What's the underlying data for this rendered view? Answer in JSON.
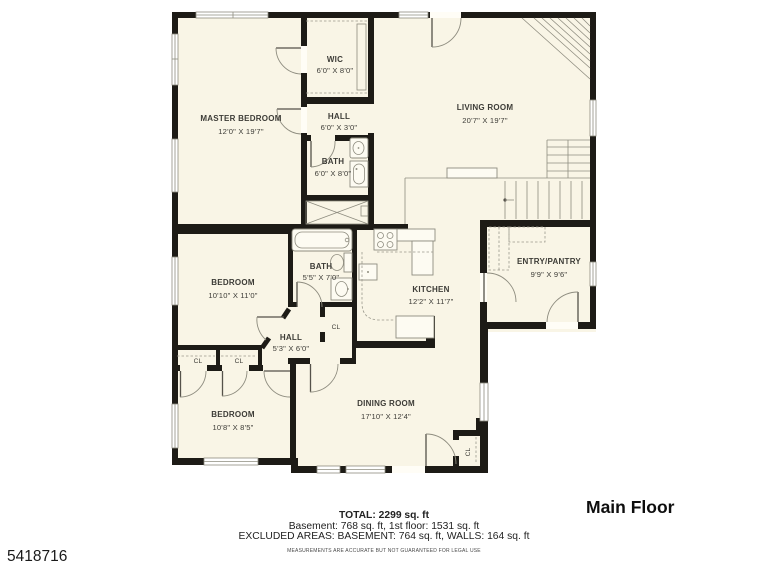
{
  "page": {
    "listing_id": "5418716",
    "floor_label": "Main Floor"
  },
  "palette": {
    "floor_fill": "#f9f5e6",
    "wall": "#1d1b16",
    "thin_line": "#8e8c7f",
    "label_text": "#3d3c37"
  },
  "rooms": {
    "master_bedroom": {
      "name": "MASTER BEDROOM",
      "dims": "12'0\" X 19'7\""
    },
    "wic": {
      "name": "WIC",
      "dims": "6'0\" X 8'0\""
    },
    "hall_upper": {
      "name": "HALL",
      "dims": "6'0\" X 3'0\""
    },
    "bath_upper": {
      "name": "BATH",
      "dims": "6'0\" X 8'0\""
    },
    "living_room": {
      "name": "LIVING ROOM",
      "dims": "20'7\" X 19'7\""
    },
    "bedroom_mid": {
      "name": "BEDROOM",
      "dims": "10'10\" X 11'0\""
    },
    "bath_main": {
      "name": "BATH",
      "dims": "5'5\" X 7'0\""
    },
    "kitchen": {
      "name": "KITCHEN",
      "dims": "12'2\" X 11'7\""
    },
    "entry_pantry": {
      "name": "ENTRY/PANTRY",
      "dims": "9'9\" X 9'6\""
    },
    "hall_lower": {
      "name": "HALL",
      "dims": "5'3\" X 6'0\""
    },
    "bedroom_lower": {
      "name": "BEDROOM",
      "dims": "10'8\" X 8'5\""
    },
    "dining_room": {
      "name": "DINING ROOM",
      "dims": "17'10\" X 12'4\""
    }
  },
  "labels": {
    "closet": "CL"
  },
  "footer": {
    "total": "TOTAL: 2299 sq. ft",
    "areas": "Basement: 768 sq. ft, 1st floor: 1531 sq. ft",
    "excluded": "EXCLUDED AREAS: BASEMENT: 764 sq. ft, WALLS: 164 sq. ft",
    "disclaimer": "MEASUREMENTS ARE ACCURATE BUT NOT GUARANTEED FOR LEGAL USE"
  }
}
